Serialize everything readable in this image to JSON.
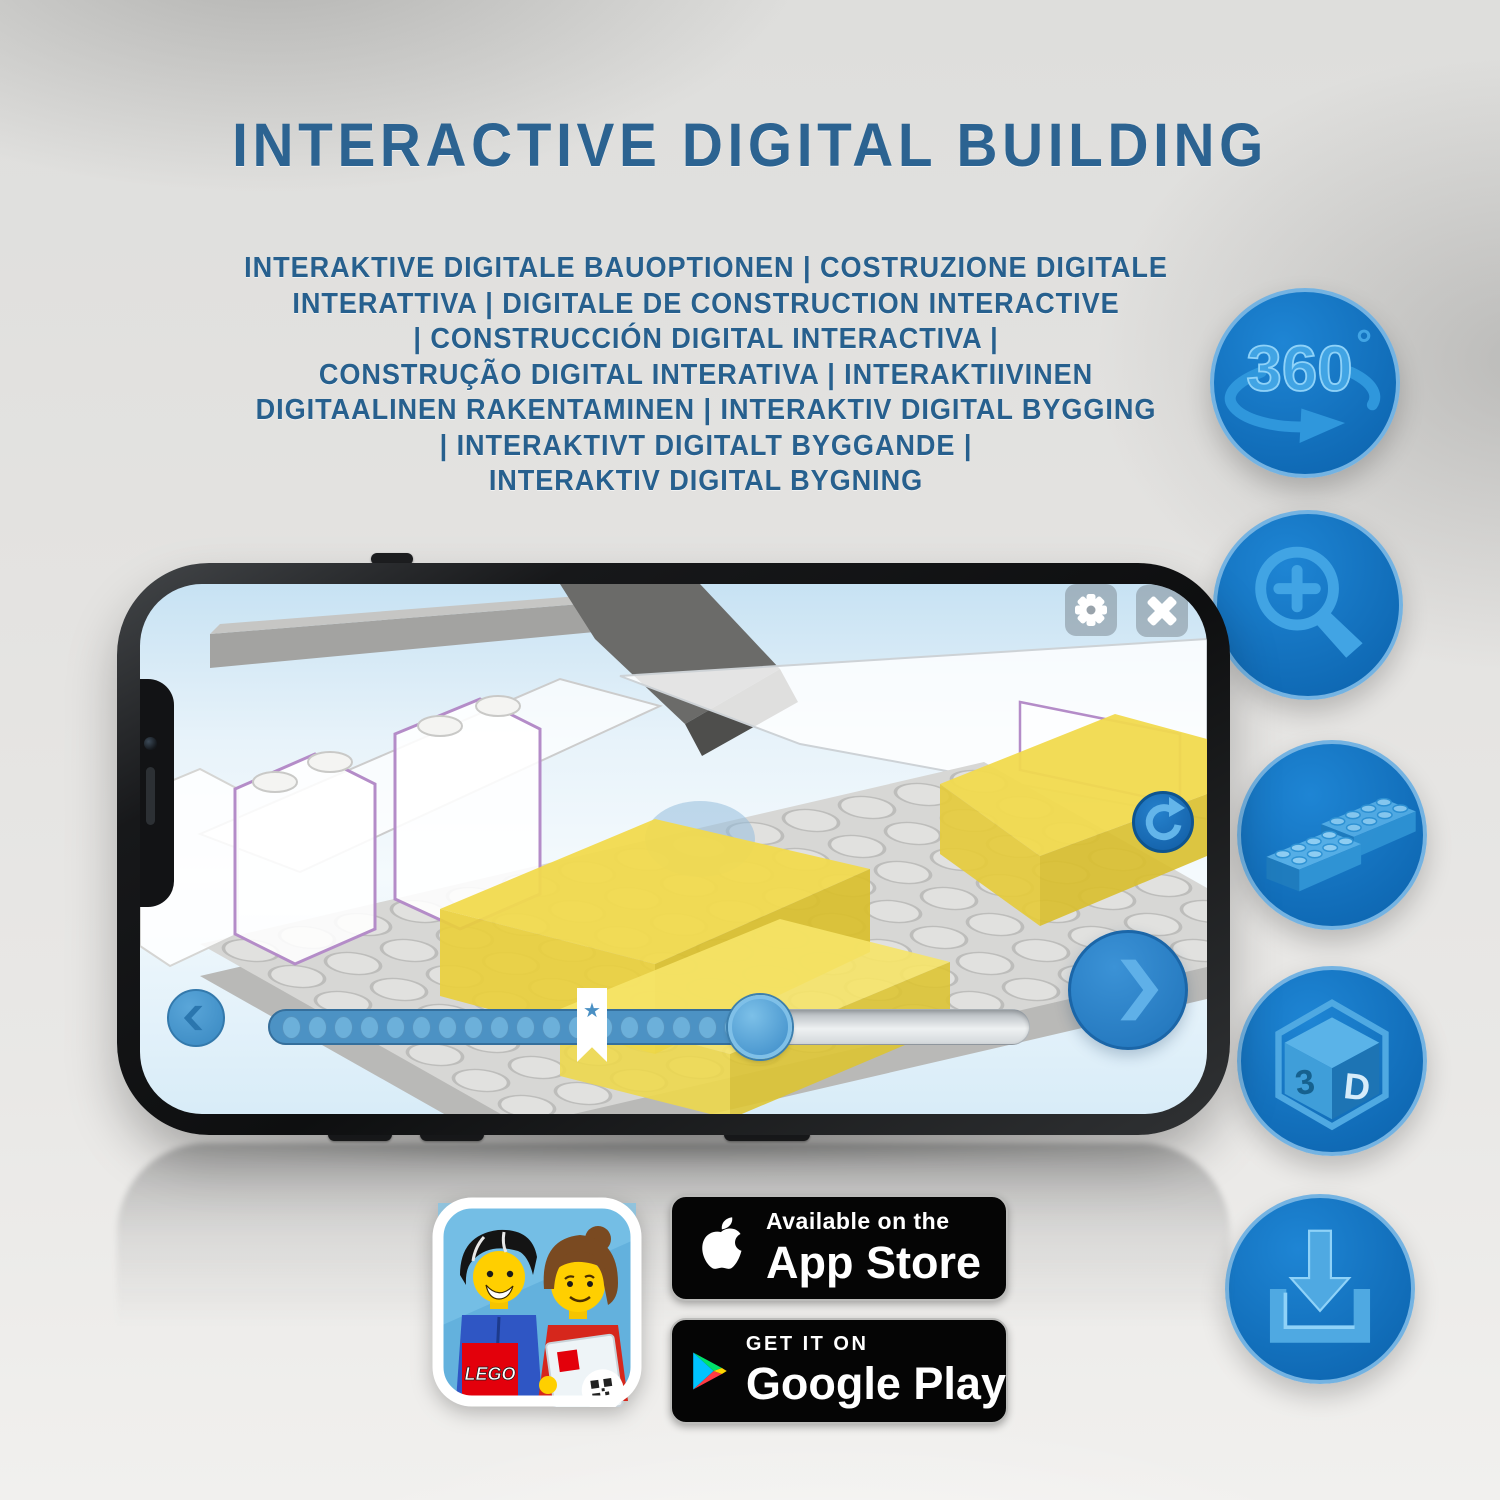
{
  "header": {
    "title": "INTERACTIVE DIGITAL BUILDING",
    "subtitle_lines": [
      "INTERAKTIVE DIGITALE BAUOPTIONEN | COSTRUZIONE DIGITALE",
      "INTERATTIVA | DIGITALE DE CONSTRUCTION INTERACTIVE",
      "| CONSTRUCCIÓN DIGITAL INTERACTIVA |",
      "CONSTRUÇÃO DIGITAL INTERATIVA | INTERAKTIIVINEN",
      "DIGITAALINEN RAKENTAMINEN | INTERAKTIV DIGITAL BYGGING",
      "| INTERAKTIVT DIGITALT BYGGANDE |",
      "INTERAKTIV DIGITAL BYGNING"
    ]
  },
  "feature_icons": {
    "rotation_360": {
      "text": "360",
      "degree": "°"
    },
    "cube_3d": {
      "left": "3",
      "right": "D"
    }
  },
  "store": {
    "app_icon": {
      "logo": "LEGO"
    },
    "app_store": {
      "tagline": "Available on the",
      "name": "App Store"
    },
    "google_play": {
      "tagline": "GET IT ON",
      "name": "Google Play"
    }
  },
  "colors": {
    "title_blue": "#2c6391",
    "icon_circle_blue": "#1474c4",
    "icon_glyph_blue": "#41a4e4",
    "lego_yellow": "#f1da4e",
    "progress_fill": "#4c92c4"
  }
}
